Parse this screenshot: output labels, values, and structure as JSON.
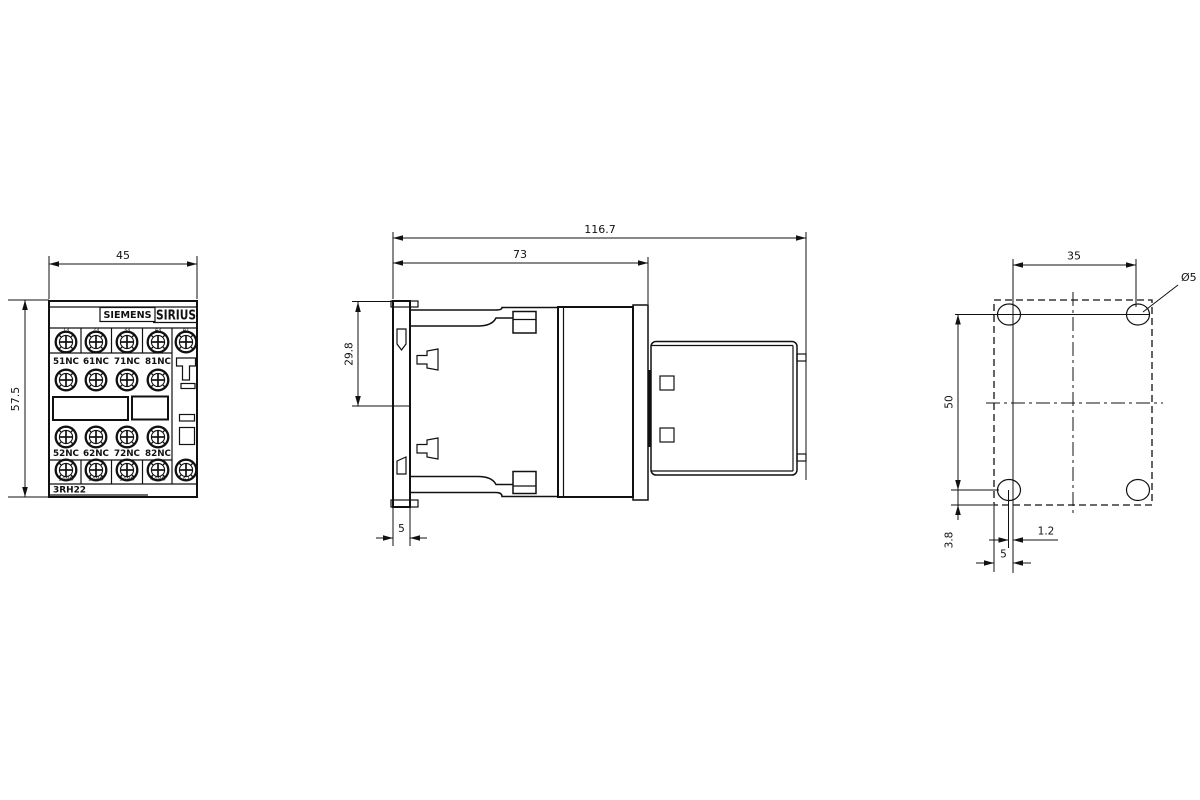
{
  "front": {
    "width_dim": "45",
    "height_dim": "57.5",
    "brand": "SIEMENS",
    "series": "SIRIUS",
    "model": "3RH22",
    "terminals_top": [
      "13",
      "23",
      "33",
      "43",
      "A1"
    ],
    "nc_upper": [
      "51NC",
      "61NC",
      "71NC",
      "81NC"
    ],
    "nc_lower": [
      "52NC",
      "62NC",
      "72NC",
      "82NC"
    ],
    "terminals_bottom": [
      "14NO",
      "24NO",
      "34NO",
      "44NO",
      "A2"
    ]
  },
  "side": {
    "overall_depth_dim": "116.7",
    "body_depth_dim": "73",
    "din_offset_dim": "29.8",
    "plate_width_dim": "5"
  },
  "drill": {
    "hole_pitch_h_dim": "35",
    "hole_pitch_v_dim": "50",
    "offset_v_dim": "3.8",
    "offset_h_dim": "1.2",
    "edge_offset_dim": "5",
    "hole_dia": "Ø5"
  }
}
